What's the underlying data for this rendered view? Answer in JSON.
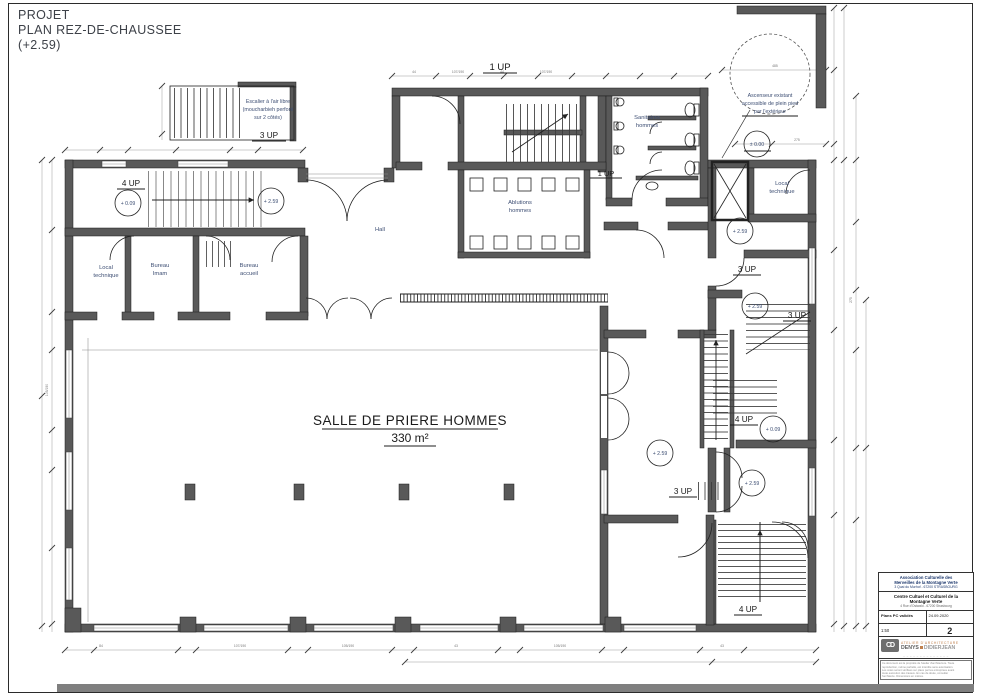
{
  "header": {
    "line1": "PROJET",
    "line2": "PLAN REZ-DE-CHAUSSEE",
    "line3": "(+2.59)"
  },
  "labels": {
    "hall": "Hall",
    "prayer_title": "SALLE DE PRIERE HOMMES",
    "prayer_area": "330 m²",
    "ablutions_l1": "Ablutions",
    "ablutions_l2": "hommes",
    "sanitaires_l1": "Sanitaires",
    "sanitaires_l2": "hommes",
    "bureau_imam_l1": "Bureau",
    "bureau_imam_l2": "Imam",
    "bureau_accueil_l1": "Bureau",
    "bureau_accueil_l2": "accueil",
    "local_tech_l1": "Local",
    "local_tech_l2": "technique",
    "escalier_l1": "Escalier à l'air libre",
    "escalier_l2": "(moucharbieh perforé",
    "escalier_l3": "sur 2 côtés)",
    "ascenseur_l1": "Ascenseur existant",
    "ascenseur_l2": "accessible de plein pied",
    "ascenseur_l3": "par l'extérieur"
  },
  "levels": {
    "p009": "+ 0.09",
    "p259": "+ 2.59",
    "p000": "± 0.00"
  },
  "stairs": {
    "up1": "1 UP",
    "up3": "3 UP",
    "up4": "4 UP"
  },
  "dims": {
    "d44": "44",
    "d107": "107/190",
    "d105": "105/190",
    "d485": "485",
    "d275": "275",
    "d84": "84",
    "d43": "43"
  },
  "titleblock": {
    "assoc1": "Association Culturelle des",
    "assoc2": "Merveilles de la Montagne Verte",
    "assoc3": "3 Quai du Murhof - 67200 STRASBOURG",
    "proj1": "Centre Cultuel et Culturel de la",
    "proj2": "Montagne Verte",
    "proj3": "4 Rue d'Ostwald - 67200 Strasbourg",
    "phase": "Plans PC validés",
    "date": "24.09.2020",
    "scale": "1:50",
    "sheet": "2",
    "firm_type": "ATELIER D'ARCHITECTURE",
    "firm_name1": "DENYS",
    "firm_name2": "DIDIERJEAN",
    "logo": "CD",
    "contact": "– – – – – – – – – – – – – –",
    "note1": "Ce document est la propriété de l'atelier d'architecture. Toute",
    "note2": "reproduction, même partielle, est interdite sans autorisation.",
    "note3": "Les cotes seront vérifiées sur place par les entreprises avant",
    "note4": "toute exécution des travaux. En cas de doute, consulter",
    "note5": "l'architecte. Dimensions en mètres."
  }
}
